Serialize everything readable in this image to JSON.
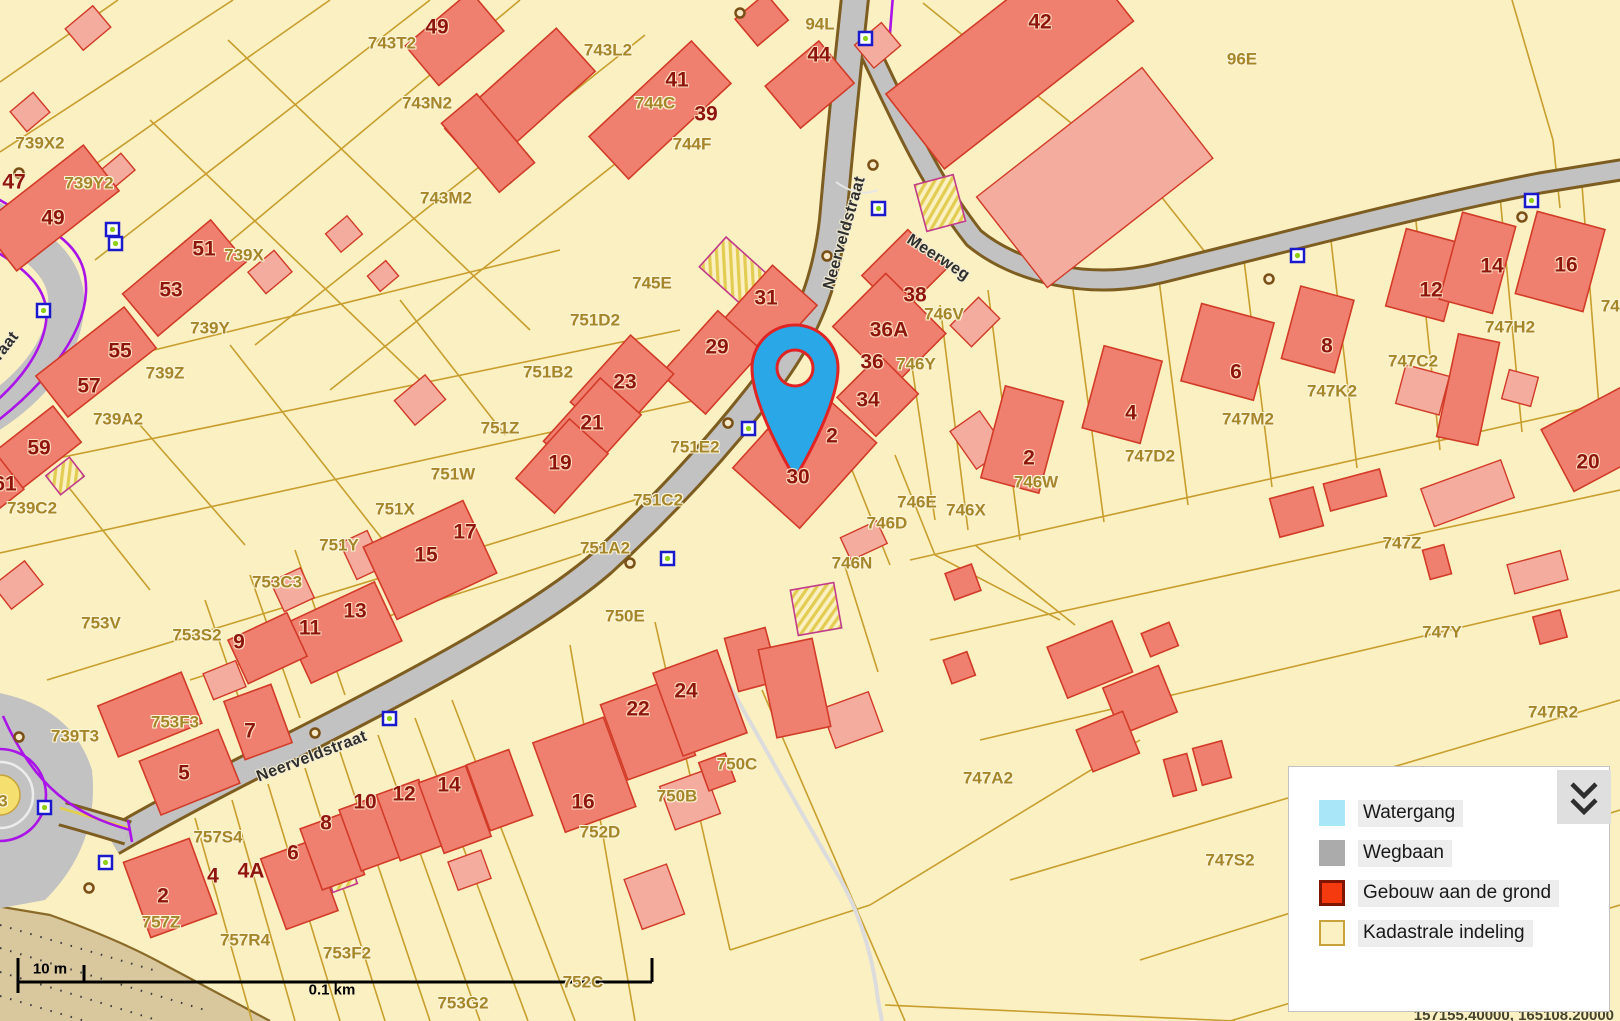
{
  "map": {
    "title": "Kadastrale kaart",
    "colors": {
      "background": "#FBF0C2",
      "parcel_line": "#C89E2E",
      "building_fill": "#EF8070",
      "building_light_fill": "#F3AC9E",
      "building_stroke": "#D23B28",
      "road_fill": "#C2C2C2",
      "road_casing": "#7D5D20",
      "boundary_purple": "#AA14E8",
      "pin_fill": "#2AA7E6",
      "pin_stroke": "#E02323",
      "tan_area": "#D9C79D"
    }
  },
  "street_labels": [
    {
      "text": "Neerveldstraat",
      "x": 845,
      "y": 233,
      "rot": -74
    },
    {
      "text": "Meerweg",
      "x": 938,
      "y": 258,
      "rot": 33
    },
    {
      "text": "Neerveldstraat",
      "x": 312,
      "y": 757,
      "rot": -21
    },
    {
      "text": "Neerveldstraat",
      "x": -20,
      "y": 380,
      "rot": -52
    }
  ],
  "house_numbers": [
    {
      "text": "49",
      "x": 437,
      "y": 27
    },
    {
      "text": "44",
      "x": 819,
      "y": 55
    },
    {
      "text": "41",
      "x": 677,
      "y": 80
    },
    {
      "text": "39",
      "x": 706,
      "y": 114
    },
    {
      "text": "42",
      "x": 1040,
      "y": 22
    },
    {
      "text": "47",
      "x": 14,
      "y": 182
    },
    {
      "text": "49",
      "x": 53,
      "y": 218
    },
    {
      "text": "51",
      "x": 204,
      "y": 249
    },
    {
      "text": "53",
      "x": 171,
      "y": 290
    },
    {
      "text": "55",
      "x": 120,
      "y": 351
    },
    {
      "text": "57",
      "x": 89,
      "y": 386
    },
    {
      "text": "59",
      "x": 39,
      "y": 448
    },
    {
      "text": "61",
      "x": 5,
      "y": 484
    },
    {
      "text": "31",
      "x": 766,
      "y": 298
    },
    {
      "text": "29",
      "x": 717,
      "y": 347
    },
    {
      "text": "23",
      "x": 625,
      "y": 382
    },
    {
      "text": "21",
      "x": 592,
      "y": 423
    },
    {
      "text": "19",
      "x": 560,
      "y": 463
    },
    {
      "text": "17",
      "x": 465,
      "y": 532
    },
    {
      "text": "15",
      "x": 426,
      "y": 555
    },
    {
      "text": "13",
      "x": 355,
      "y": 611
    },
    {
      "text": "11",
      "x": 310,
      "y": 628
    },
    {
      "text": "9",
      "x": 239,
      "y": 642
    },
    {
      "text": "7",
      "x": 250,
      "y": 731
    },
    {
      "text": "5",
      "x": 184,
      "y": 773
    },
    {
      "text": "38",
      "x": 915,
      "y": 295
    },
    {
      "text": "36A",
      "x": 889,
      "y": 330
    },
    {
      "text": "36",
      "x": 872,
      "y": 362
    },
    {
      "text": "34",
      "x": 868,
      "y": 400
    },
    {
      "text": "2",
      "x": 832,
      "y": 436
    },
    {
      "text": "30",
      "x": 798,
      "y": 477
    },
    {
      "text": "2",
      "x": 1029,
      "y": 458
    },
    {
      "text": "4",
      "x": 1131,
      "y": 413
    },
    {
      "text": "6",
      "x": 1236,
      "y": 372
    },
    {
      "text": "8",
      "x": 1327,
      "y": 346
    },
    {
      "text": "12",
      "x": 1431,
      "y": 290
    },
    {
      "text": "14",
      "x": 1492,
      "y": 266
    },
    {
      "text": "16",
      "x": 1566,
      "y": 265
    },
    {
      "text": "20",
      "x": 1588,
      "y": 462
    },
    {
      "text": "2",
      "x": 163,
      "y": 896
    },
    {
      "text": "4",
      "x": 213,
      "y": 876
    },
    {
      "text": "4A",
      "x": 251,
      "y": 871
    },
    {
      "text": "6",
      "x": 293,
      "y": 853
    },
    {
      "text": "8",
      "x": 326,
      "y": 823
    },
    {
      "text": "10",
      "x": 365,
      "y": 802
    },
    {
      "text": "12",
      "x": 404,
      "y": 794
    },
    {
      "text": "14",
      "x": 449,
      "y": 785
    },
    {
      "text": "22",
      "x": 638,
      "y": 709
    },
    {
      "text": "24",
      "x": 686,
      "y": 691
    },
    {
      "text": "16",
      "x": 583,
      "y": 802
    }
  ],
  "parcel_labels": [
    {
      "text": "743T2",
      "x": 392,
      "y": 43
    },
    {
      "text": "743L2",
      "x": 608,
      "y": 50
    },
    {
      "text": "743N2",
      "x": 427,
      "y": 103
    },
    {
      "text": "744C",
      "x": 655,
      "y": 103
    },
    {
      "text": "744F",
      "x": 692,
      "y": 144
    },
    {
      "text": "743M2",
      "x": 446,
      "y": 198
    },
    {
      "text": "94L",
      "x": 820,
      "y": 24
    },
    {
      "text": "96E",
      "x": 1242,
      "y": 59
    },
    {
      "text": "739X2",
      "x": 40,
      "y": 143
    },
    {
      "text": "739Y2",
      "x": 89,
      "y": 183
    },
    {
      "text": "739X",
      "x": 244,
      "y": 255
    },
    {
      "text": "739Y",
      "x": 210,
      "y": 328
    },
    {
      "text": "739Z",
      "x": 165,
      "y": 373
    },
    {
      "text": "739A2",
      "x": 118,
      "y": 419
    },
    {
      "text": "739C2",
      "x": 32,
      "y": 508
    },
    {
      "text": "745E",
      "x": 652,
      "y": 283
    },
    {
      "text": "751D2",
      "x": 595,
      "y": 320
    },
    {
      "text": "751B2",
      "x": 548,
      "y": 372
    },
    {
      "text": "751Z",
      "x": 500,
      "y": 428
    },
    {
      "text": "751W",
      "x": 453,
      "y": 474
    },
    {
      "text": "751X",
      "x": 395,
      "y": 509
    },
    {
      "text": "751Y",
      "x": 339,
      "y": 545
    },
    {
      "text": "751E2",
      "x": 695,
      "y": 447
    },
    {
      "text": "751C2",
      "x": 658,
      "y": 500
    },
    {
      "text": "751A2",
      "x": 605,
      "y": 548
    },
    {
      "text": "750E",
      "x": 625,
      "y": 616
    },
    {
      "text": "753C3",
      "x": 277,
      "y": 582
    },
    {
      "text": "753V",
      "x": 101,
      "y": 623
    },
    {
      "text": "753S2",
      "x": 197,
      "y": 635
    },
    {
      "text": "753F3",
      "x": 175,
      "y": 722
    },
    {
      "text": "739T3",
      "x": 75,
      "y": 736
    },
    {
      "text": "757S4",
      "x": 218,
      "y": 837
    },
    {
      "text": "757Z",
      "x": 161,
      "y": 922
    },
    {
      "text": "757R4",
      "x": 245,
      "y": 940
    },
    {
      "text": "753F2",
      "x": 347,
      "y": 953
    },
    {
      "text": "753G2",
      "x": 463,
      "y": 1003
    },
    {
      "text": "752D",
      "x": 600,
      "y": 832
    },
    {
      "text": "750B",
      "x": 677,
      "y": 796
    },
    {
      "text": "750C",
      "x": 737,
      "y": 764
    },
    {
      "text": "752C",
      "x": 583,
      "y": 982
    },
    {
      "text": "747A2",
      "x": 988,
      "y": 778
    },
    {
      "text": "746V",
      "x": 944,
      "y": 314
    },
    {
      "text": "746Y",
      "x": 916,
      "y": 364
    },
    {
      "text": "746W",
      "x": 1036,
      "y": 482
    },
    {
      "text": "746E",
      "x": 917,
      "y": 502
    },
    {
      "text": "746X",
      "x": 966,
      "y": 510
    },
    {
      "text": "746D",
      "x": 887,
      "y": 523
    },
    {
      "text": "746N",
      "x": 852,
      "y": 563
    },
    {
      "text": "747D2",
      "x": 1150,
      "y": 456
    },
    {
      "text": "747M2",
      "x": 1248,
      "y": 419
    },
    {
      "text": "747K2",
      "x": 1332,
      "y": 391
    },
    {
      "text": "747C2",
      "x": 1413,
      "y": 361
    },
    {
      "text": "747H2",
      "x": 1510,
      "y": 327
    },
    {
      "text": "747Z",
      "x": 1402,
      "y": 543
    },
    {
      "text": "747Y",
      "x": 1442,
      "y": 632
    },
    {
      "text": "747R2",
      "x": 1553,
      "y": 712
    },
    {
      "text": "747S2",
      "x": 1230,
      "y": 860
    },
    {
      "text": "747",
      "x": 1615,
      "y": 306
    },
    {
      "text": "3",
      "x": 3,
      "y": 801
    }
  ],
  "legend": {
    "items": [
      {
        "label": "Watergang",
        "fill": "#A9E6F8",
        "border": "#A9E6F8",
        "border_w": 2
      },
      {
        "label": "Wegbaan",
        "fill": "#ABABAB",
        "border": "#ABABAB",
        "border_w": 2
      },
      {
        "label": "Gebouw aan de grond",
        "fill": "#F63A10",
        "border": "#801500",
        "border_w": 3
      },
      {
        "label": "Kadastrale indeling",
        "fill": "#FBF1C3",
        "border": "#C8A23A",
        "border_w": 2
      }
    ],
    "collapse_icon": "chevron-double-down"
  },
  "scalebar": {
    "left_label": "10 m",
    "right_label": "0.1 km"
  },
  "coordinates": "157155.40000, 165108.20000"
}
